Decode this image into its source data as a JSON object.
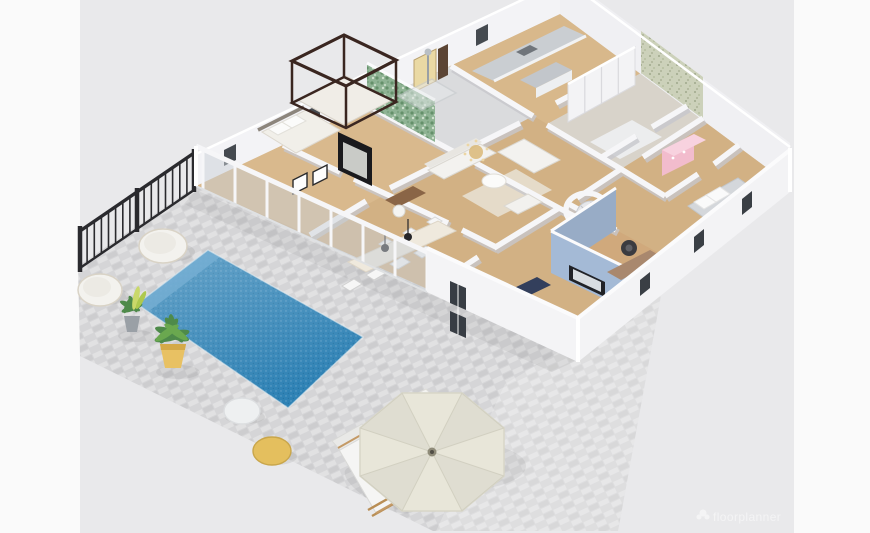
{
  "scene": {
    "description": "Isometric 3D render of a single-storey house floor plan with pool terrace",
    "view": "isometric-3d"
  },
  "watermark": {
    "logo": "flower-icon",
    "text": "floorplanner"
  },
  "palette": {
    "background": "#e9e9eb",
    "margin": "#fafafa",
    "patio": "#d5d5d7",
    "pool": "#2f82b5",
    "pool_step": "#74aed2",
    "fence": "#2a2a2e",
    "wall": "#f6f6f8",
    "wall_shadow": "#c7c7cc",
    "floor_wood": "#d2b184",
    "floor_wood_light": "#d9b98d",
    "tile": "#dadbdd",
    "green_wall": "#8fb394",
    "wallpaper": "#ccd1ba",
    "blue_wall": "#a4bad6",
    "pink": "#f2bccd",
    "navy": "#333f5c",
    "umbrella": "#e8e6d9",
    "pouf_yellow": "#e4bf5e",
    "pot_yellow": "#e8c163",
    "plant_green": "#4e8a4a",
    "daybed": "#f3f2ee",
    "counter": "#caced2",
    "bed_frame_dark": "#3a2620",
    "watermark_color": "#ffffff"
  },
  "objects": [
    {
      "name": "pool-terrace"
    },
    {
      "name": "swimming-pool"
    },
    {
      "name": "railing-fence"
    },
    {
      "name": "round-daybeds"
    },
    {
      "name": "potted-plants"
    },
    {
      "name": "poufs"
    },
    {
      "name": "parasol"
    },
    {
      "name": "sun-loungers"
    },
    {
      "name": "glass-sliding-doors"
    },
    {
      "name": "four-poster-bed"
    },
    {
      "name": "shower-bathroom"
    },
    {
      "name": "kitchen"
    },
    {
      "name": "living-room-sofas"
    },
    {
      "name": "dining-set"
    },
    {
      "name": "spiral-staircase"
    },
    {
      "name": "tv-room-blue-wall"
    },
    {
      "name": "wardrobe"
    },
    {
      "name": "pink-dresser"
    },
    {
      "name": "bedrooms"
    },
    {
      "name": "home-office"
    }
  ]
}
